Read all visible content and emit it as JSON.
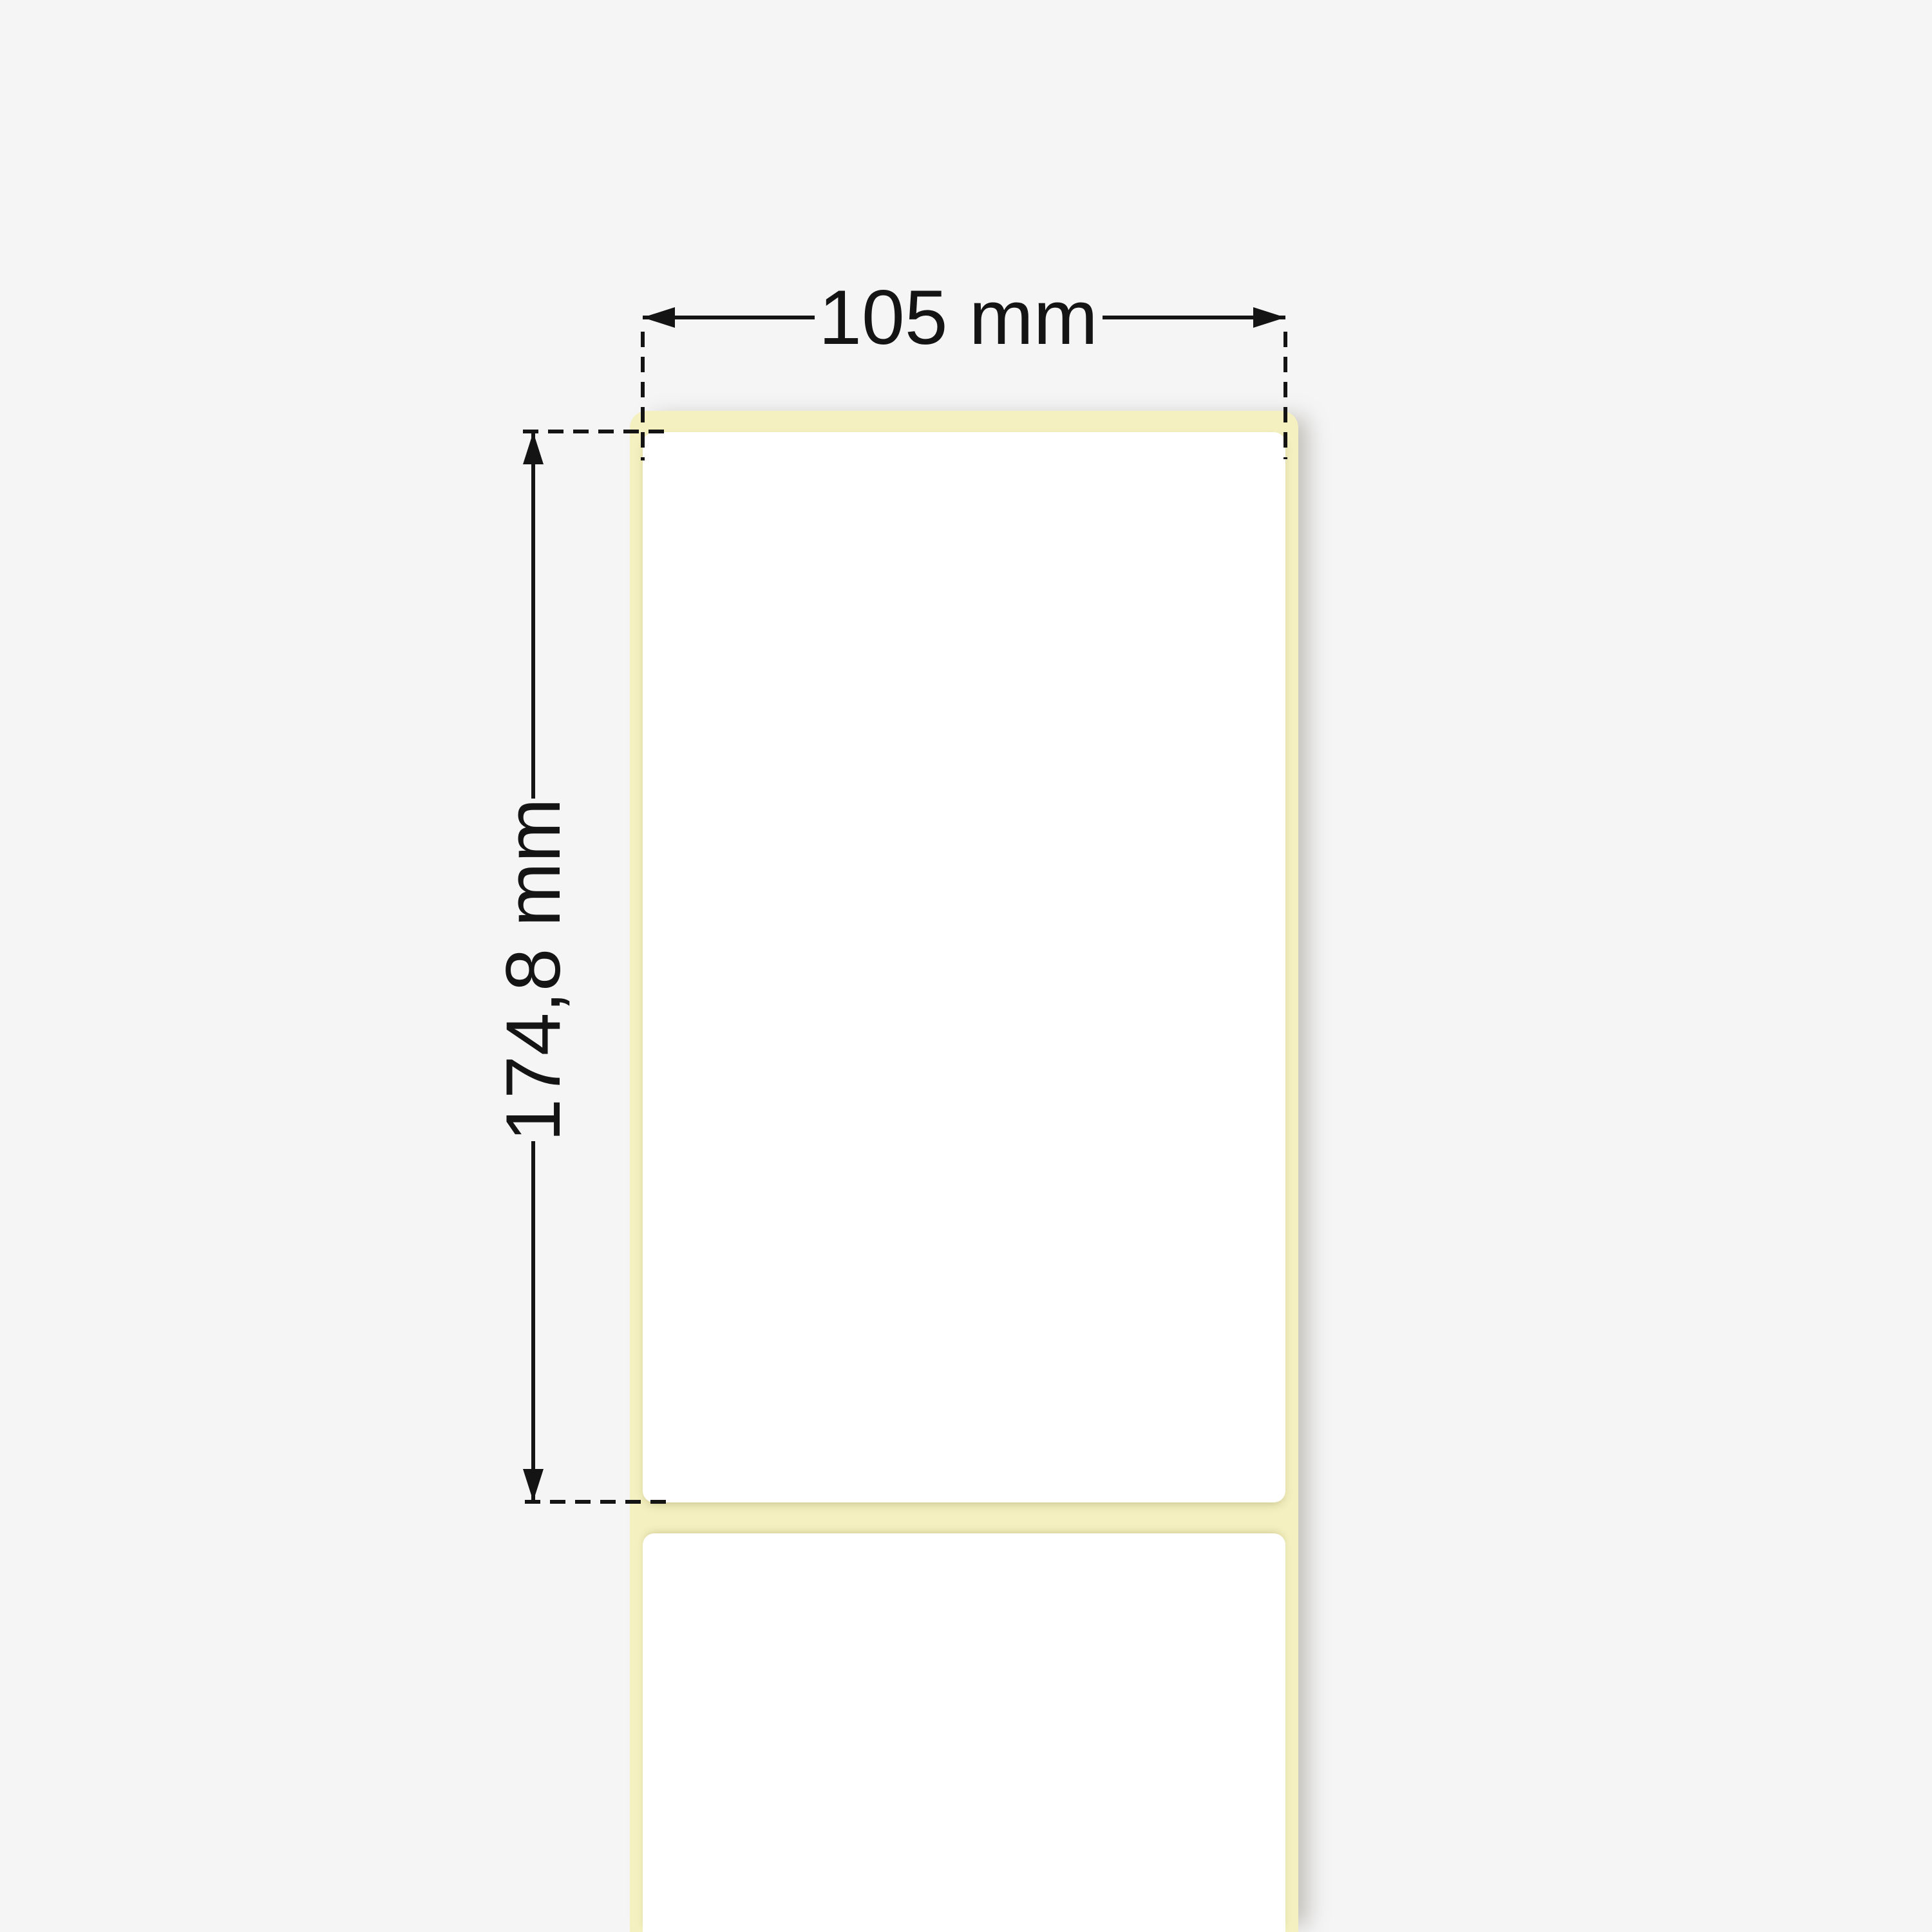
{
  "diagram": {
    "type": "label-dimension-drawing",
    "width_dimension": {
      "label": "105 mm"
    },
    "height_dimension": {
      "label": "174,8 mm"
    },
    "labels_visible": 2
  },
  "colors": {
    "bg": "#f5f5f6",
    "liner": "#f4f0bf",
    "label": "#ffffff",
    "line": "#141414",
    "liner-shadow": "rgba(110,105,85,0.40)",
    "label-shadow": "rgba(130,120,60,0.40)"
  }
}
